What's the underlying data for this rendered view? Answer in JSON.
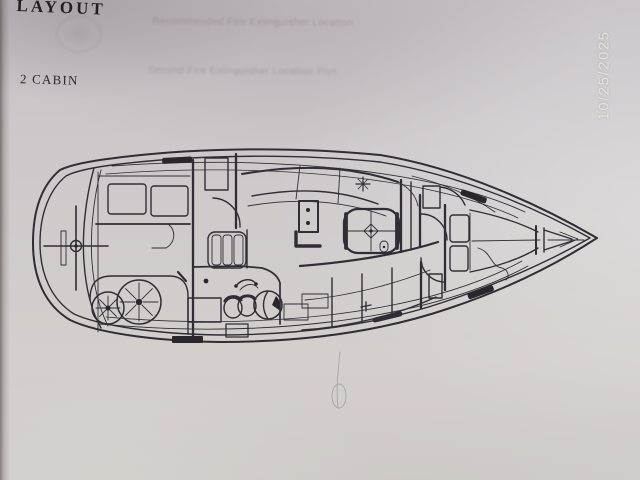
{
  "page": {
    "title": "LAYOUT",
    "variant_label": "2 CABIN",
    "date_stamp": "10/25/2025"
  },
  "bleedthrough": {
    "line1": "Recommended Fire Extinguisher Location",
    "line2": "Second Fire Extinguisher Location Port"
  },
  "diagram": {
    "description": "Top-view line drawing of a 2-cabin sailboat interior layout, bow pointing right",
    "ink_color": "#322d34",
    "paper_color": "#cfc9cb",
    "features": [
      "hull-outline",
      "stern-swim-platform",
      "helm-cross",
      "aft-cabin-berth",
      "twin-spoked-wheels",
      "hanging-lockers-hatched",
      "companionway-steps",
      "galley-stove",
      "galley-sinks",
      "saloon-table-with-mast-diamond",
      "nav-station",
      "port-settee",
      "starboard-settee",
      "head-compartment",
      "v-berth",
      "anchor-locker",
      "deck-cleats"
    ]
  }
}
